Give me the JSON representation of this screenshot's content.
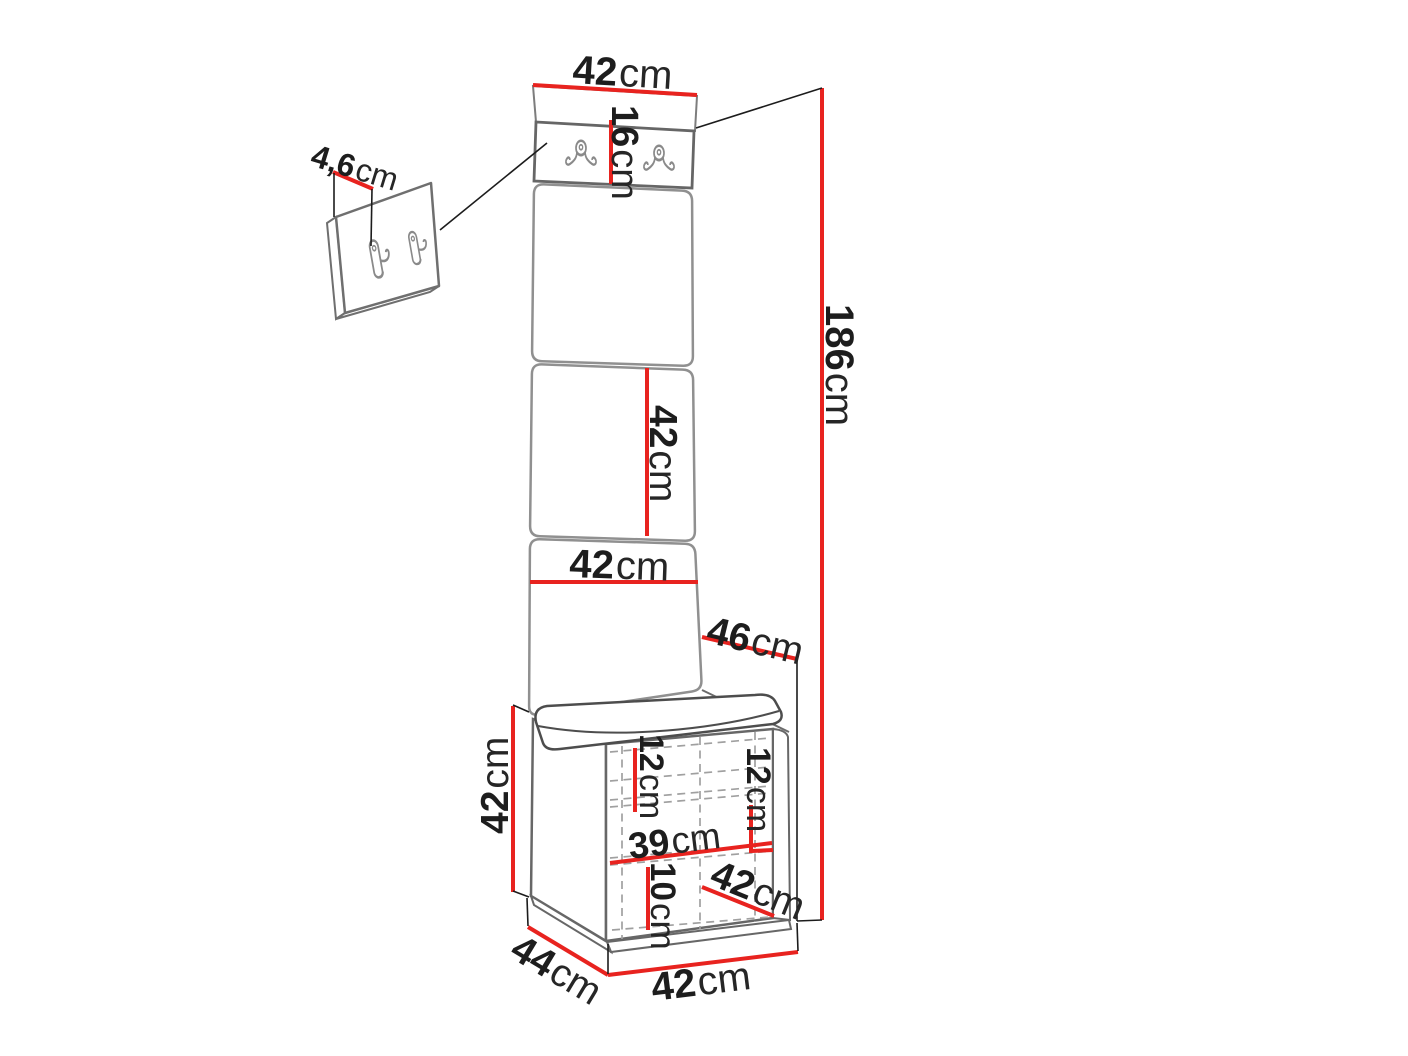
{
  "diagram": {
    "type": "furniture-dimension-diagram",
    "subject": "hallway set: wall hook panel, tall upholstered panel and bench with shelves",
    "unit": "cm",
    "colors": {
      "dimension_red": "#e8231f",
      "outline_gray": "#6b6b6b",
      "background": "#ffffff",
      "text_black": "#1d1d1d"
    },
    "icons": {
      "front_hook": "double-coat-hook-front",
      "side_hook": "double-coat-hook-side"
    },
    "dimensions": {
      "hook_panel_depth": {
        "value": "4,6",
        "unit": "cm"
      },
      "top_width": {
        "value": "42",
        "unit": "cm"
      },
      "hook_strip_height": {
        "value": "16",
        "unit": "cm"
      },
      "total_height": {
        "value": "186",
        "unit": "cm"
      },
      "middle_segment_height": {
        "value": "42",
        "unit": "cm"
      },
      "panel_width": {
        "value": "42",
        "unit": "cm"
      },
      "seat_depth": {
        "value": "46",
        "unit": "cm"
      },
      "bench_height": {
        "value": "42",
        "unit": "cm"
      },
      "upper_shelf_gap": {
        "value": "12",
        "unit": "cm"
      },
      "right_shelf_gap": {
        "value": "12",
        "unit": "cm"
      },
      "interior_width": {
        "value": "39",
        "unit": "cm"
      },
      "bottom_shelf_gap": {
        "value": "10",
        "unit": "cm"
      },
      "bench_side_diagonal": {
        "value": "42",
        "unit": "cm"
      },
      "bench_depth": {
        "value": "44",
        "unit": "cm"
      },
      "bench_width": {
        "value": "42",
        "unit": "cm"
      }
    }
  }
}
